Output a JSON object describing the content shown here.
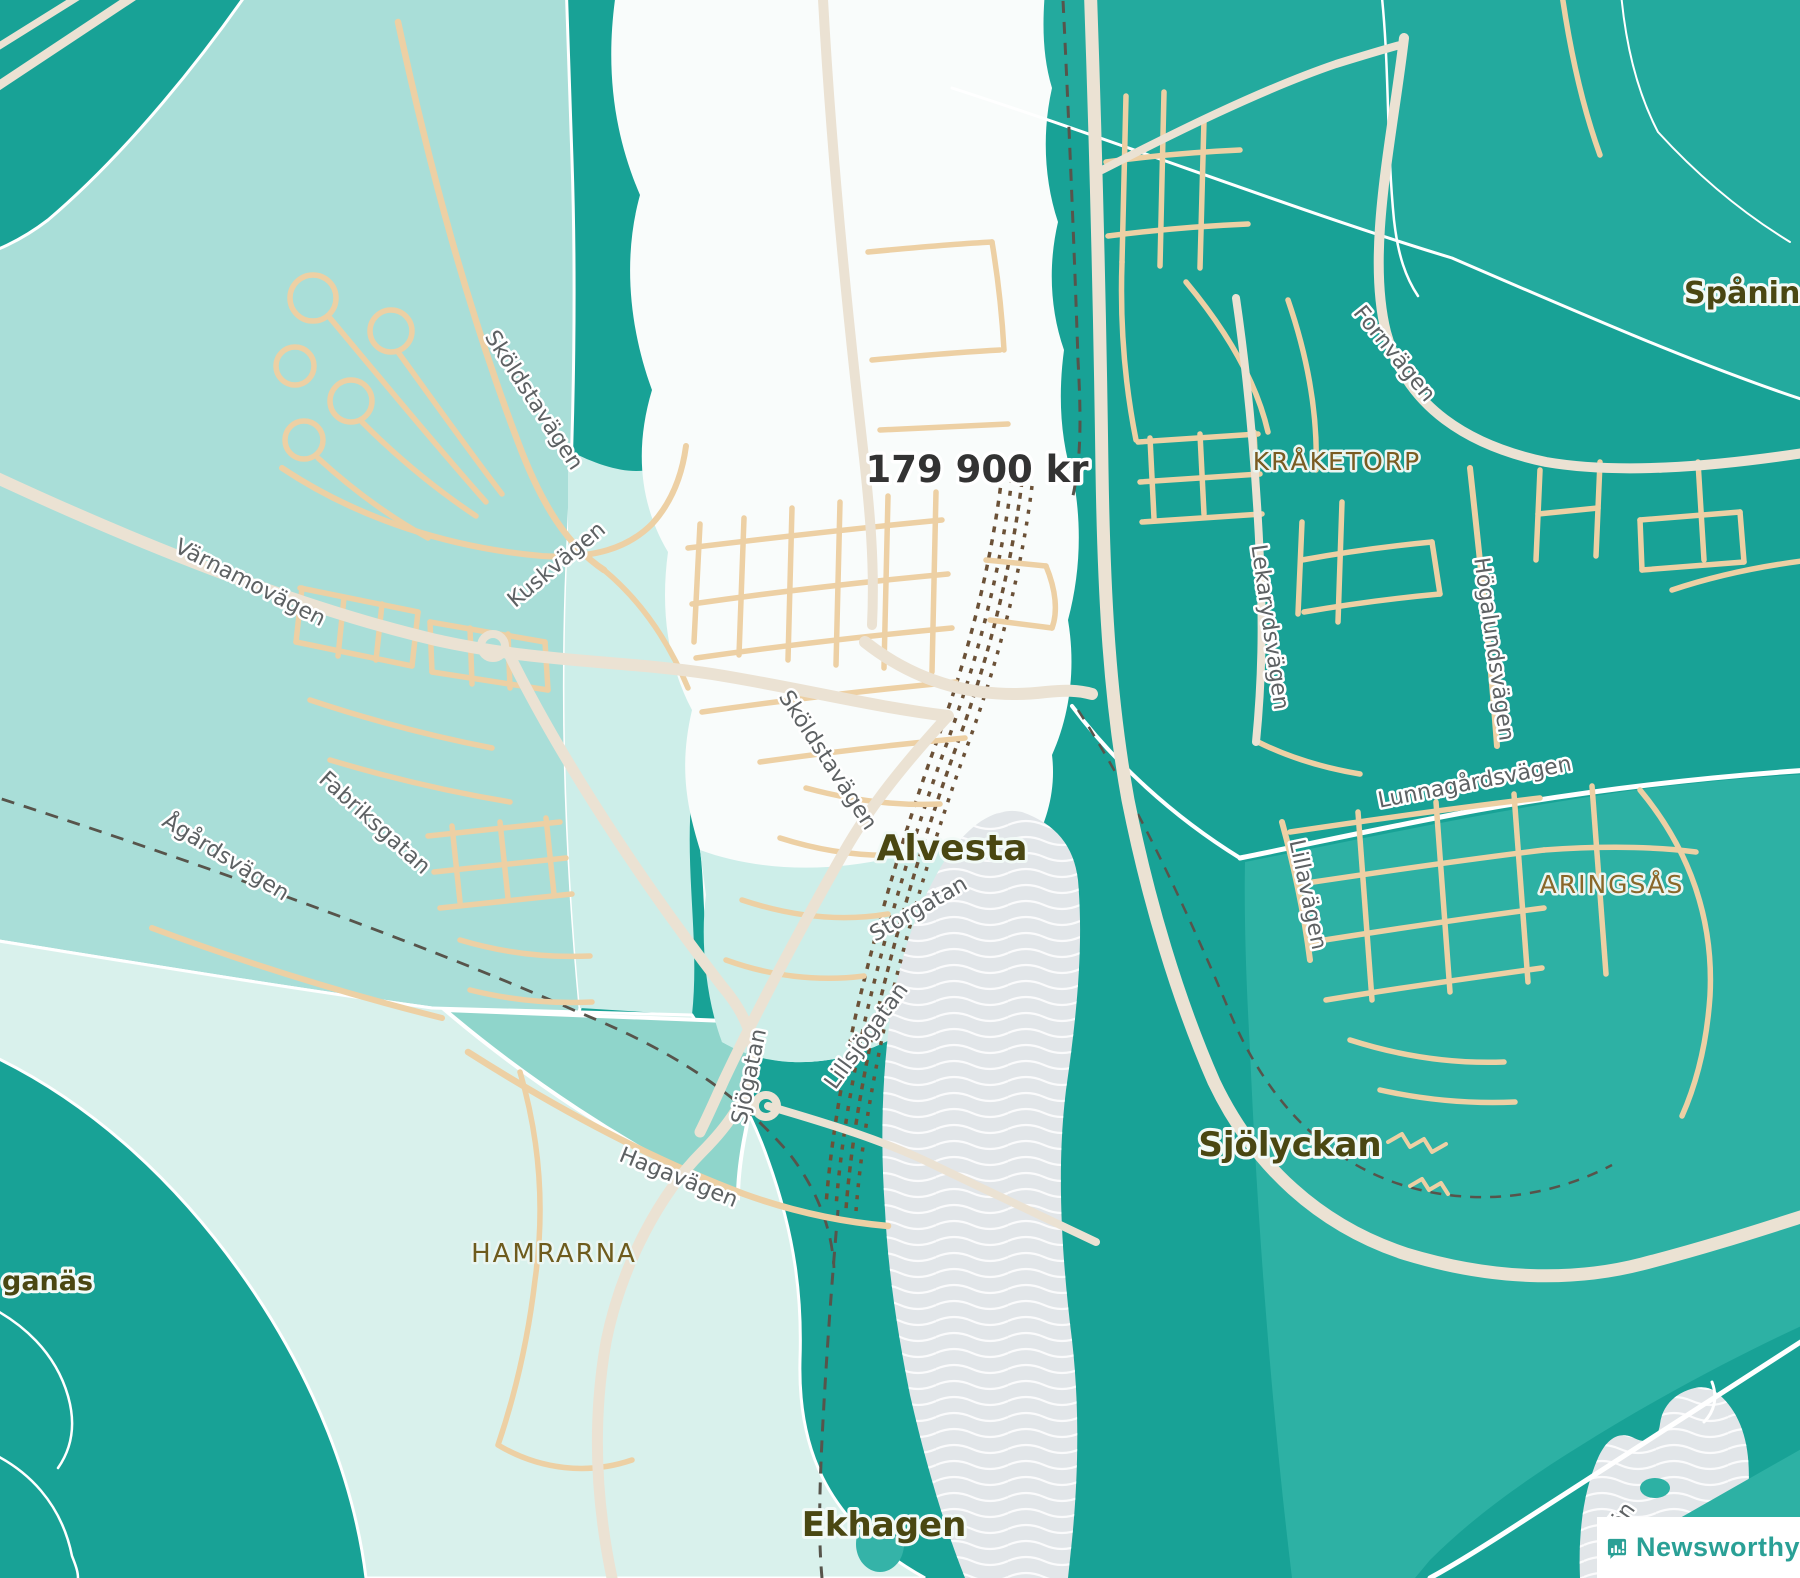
{
  "map": {
    "price_label": "179 900 kr",
    "localities": {
      "alvesta": "Alvesta",
      "ekhagen": "Ekhagen",
      "sjolyckan": "Sjölyckan",
      "hamrarna": "HAMRARNA",
      "kraketorp": "KRÅKETORP",
      "aringsas": "ARINGSÅS",
      "spaning": "Spånings",
      "ganas": "ganäs"
    },
    "streets": {
      "varnamovagen": "Värnamovägen",
      "kuskvagen": "Kuskvägen",
      "skoldstavagen_nw": "Sköldstavägen",
      "skoldstavagen_c": "Sköldstavägen",
      "fabriksgatan": "Fabriksgatan",
      "agardsvagen": "Ågårdsvägen",
      "storgatan": "Storgatan",
      "lillsjogatan": "Lillsjögatan",
      "hagavagen": "Hagavägen",
      "sjogatan": "Sjögatan",
      "fornvagen": "Fornvägen",
      "lekarydsvagen": "Lekarydsvägen",
      "hogalundsvagen": "Högalundsvägen",
      "lunnagardsvagen": "Lunnagårdsvägen",
      "lillavagen": "Lillavägen"
    },
    "water_label_fragment": "ön"
  },
  "watermark": {
    "brand": "Newsworthy"
  },
  "palette": {
    "base_teal": "#18a296",
    "topright_teal": "#23aa9e",
    "lowright_teal": "#2db1a4",
    "region_light": "#a9ded8",
    "region_pale": "#cdeee9",
    "region_mint": "#d9f1ec",
    "region_medium": "#8fd5cb",
    "region_selected": "#f9fcfb",
    "water_gray": "#e2e6e9",
    "road_major": "#ebe2d3",
    "road_minor": "#edd0a4",
    "rail_brown": "#6b5137",
    "rail_dark": "#57544b",
    "locality_olive": "#4a4712",
    "district_brown": "#7a5c22",
    "street_gray": "#5d6163",
    "price_dark": "#333333",
    "brand_teal": "#2aa096"
  }
}
